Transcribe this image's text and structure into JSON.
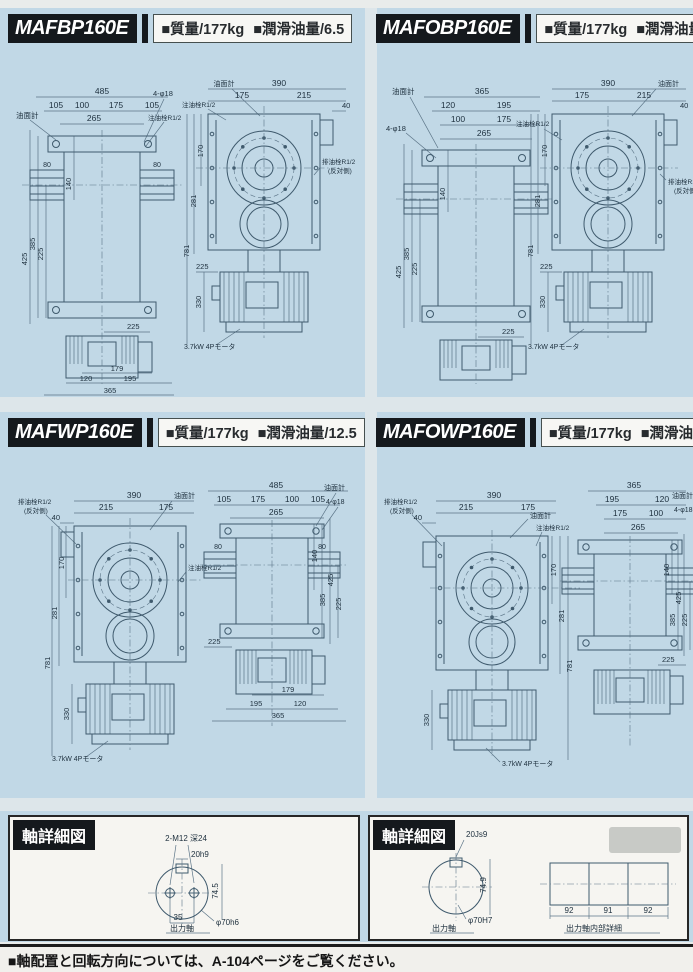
{
  "page": {
    "footer_note": "■軸配置と回転方向については、A-104ページをご覧ください。"
  },
  "panels": [
    {
      "model": "MAFBP160E",
      "mass": "■質量/177kg",
      "oil": "■潤滑油量/6.5",
      "top_view": {
        "oil_gauge": "油面計",
        "holes": "4-φ18",
        "fill_plug": "注油栓R1/2",
        "w_total": "485",
        "w1": "105",
        "w2": "100",
        "w3": "175",
        "w4": "105",
        "w_inner": "265",
        "side_l": "80",
        "side_r": "80",
        "h1": "140",
        "h2": "225",
        "h3": "385",
        "h4": "425",
        "mid": "225",
        "motor_d": "179",
        "mb1": "120",
        "mb2": "195",
        "mb_total": "365"
      },
      "face_view": {
        "oil_gauge": "油面計",
        "fill_plug": "注油栓R1/2",
        "w_total": "390",
        "w1": "175",
        "w2": "215",
        "tab": "40",
        "drain_plug": "排油栓R1/2",
        "drain_note": "(反対側)",
        "h1": "170",
        "h2": "281",
        "h3": "781",
        "base": "225",
        "motor_h": "330",
        "motor": "3.7kW 4Pモータ"
      }
    },
    {
      "model": "MAFOBP160E",
      "mass": "■質量/177kg",
      "oil": "■潤滑油量/6.5",
      "top_view": {
        "oil_gauge": "油面計",
        "holes": "4-φ18",
        "w_total": "365",
        "w1": "120",
        "w2": "195",
        "w3": "100",
        "w4": "175",
        "w_inner": "265",
        "h1": "140",
        "h2": "225",
        "h3": "385",
        "h4": "425",
        "mid": "225"
      },
      "face_view": {
        "oil_gauge": "油面計",
        "fill_plug": "注油栓R1/2",
        "w_total": "390",
        "w1": "175",
        "w2": "215",
        "tab": "40",
        "drain_plug": "排油栓R1/2",
        "drain_note": "(反対側)",
        "h1": "170",
        "h2": "281",
        "h3": "781",
        "base": "225",
        "motor_h": "330",
        "motor": "3.7kW 4Pモータ"
      }
    },
    {
      "model": "MAFWP160E",
      "mass": "■質量/177kg",
      "oil": "■潤滑油量/12.5",
      "face_view": {
        "drain_plug": "排油栓R1/2",
        "drain_note": "(反対側)",
        "oil_gauge": "油面計",
        "fill_plug": "注油栓R1/2",
        "w_total": "390",
        "w1": "215",
        "w2": "175",
        "tab": "40",
        "h1": "170",
        "h2": "281",
        "h3": "781",
        "motor_h": "330",
        "motor": "3.7kW 4Pモータ"
      },
      "top_view": {
        "oil_gauge": "油面計",
        "holes": "4-φ18",
        "w_total": "485",
        "w1": "105",
        "w2": "175",
        "w3": "100",
        "w4": "105",
        "w_inner": "265",
        "side_l": "80",
        "side_r": "80",
        "h1": "140",
        "h2": "225",
        "h3": "385",
        "h4": "425",
        "base": "225",
        "motor_d": "179",
        "mb1": "195",
        "mb2": "120",
        "mb_total": "365"
      }
    },
    {
      "model": "MAFOWP160E",
      "mass": "■質量/177kg",
      "oil": "■潤滑油量/12.5",
      "face_view": {
        "drain_plug": "排油栓R1/2",
        "drain_note": "(反対側)",
        "oil_gauge": "油面計",
        "fill_plug": "注油栓R1/2",
        "w_total": "390",
        "w1": "215",
        "w2": "175",
        "tab": "40",
        "h1": "170",
        "h2": "281",
        "h3": "781",
        "motor_h": "330",
        "motor": "3.7kW 4Pモータ"
      },
      "top_view": {
        "oil_gauge": "油面計",
        "holes": "4-φ18",
        "w_total": "365",
        "w1": "195",
        "w2": "120",
        "w3": "175",
        "w4": "100",
        "w_inner": "265",
        "h1": "140",
        "h2": "225",
        "h3": "385",
        "h4": "425",
        "mid": "225"
      }
    }
  ],
  "shaft_left": {
    "title": "軸詳細図",
    "tap": "2-M12 深24",
    "key": "20h9",
    "v_dim": "74.5",
    "hole_span": "35",
    "dia": "φ70h6",
    "caption": "出力軸"
  },
  "shaft_right": {
    "title": "軸詳細図",
    "key": "20Js9",
    "v_dim": "74.9",
    "dia": "φ70H7",
    "caption": "出力軸",
    "s1": "92",
    "s2": "91",
    "s3": "92",
    "caption2": "出力軸内部詳細"
  }
}
